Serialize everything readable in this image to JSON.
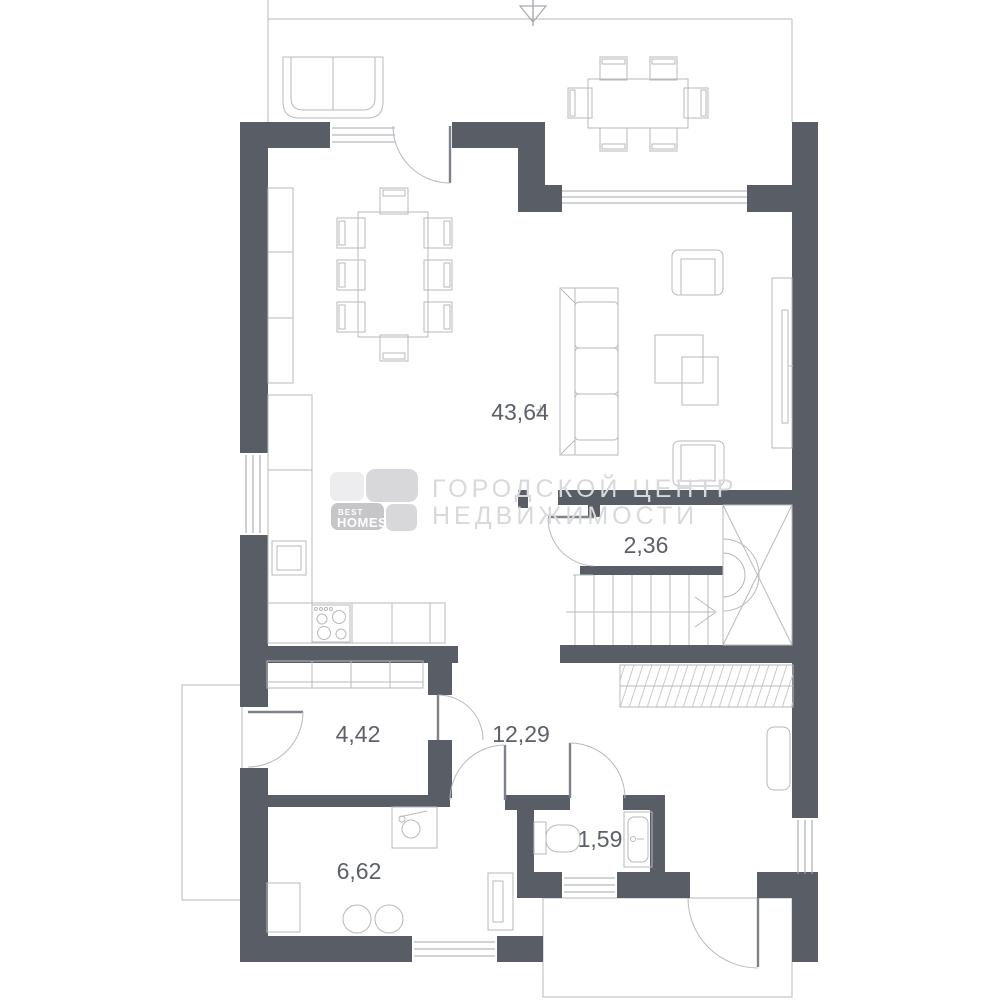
{
  "colors": {
    "wall": "#585d66",
    "line": "#b7b9be",
    "line_dark": "#9a9da4",
    "label": "#5b6069",
    "watermark": "#d8d9db",
    "logo_light": "#ededef",
    "logo_mid": "#d8d8da",
    "logo_dark": "#c6c6c9",
    "logo_text": "#ffffff"
  },
  "rooms": {
    "living_kitchen": {
      "area": "43,64"
    },
    "stair_landing": {
      "area": "2,36"
    },
    "hallway": {
      "area": "4,42"
    },
    "corridor": {
      "area": "12,29"
    },
    "wc": {
      "area": "1,59"
    },
    "utility": {
      "area": "6,62"
    }
  },
  "watermark": {
    "logo_line1": "BEST",
    "logo_line2": "HOMES",
    "text_line1": "ГОРОДСКОЙ ЦЕНТР",
    "text_line2": "НЕДВИЖИМОСТИ"
  }
}
